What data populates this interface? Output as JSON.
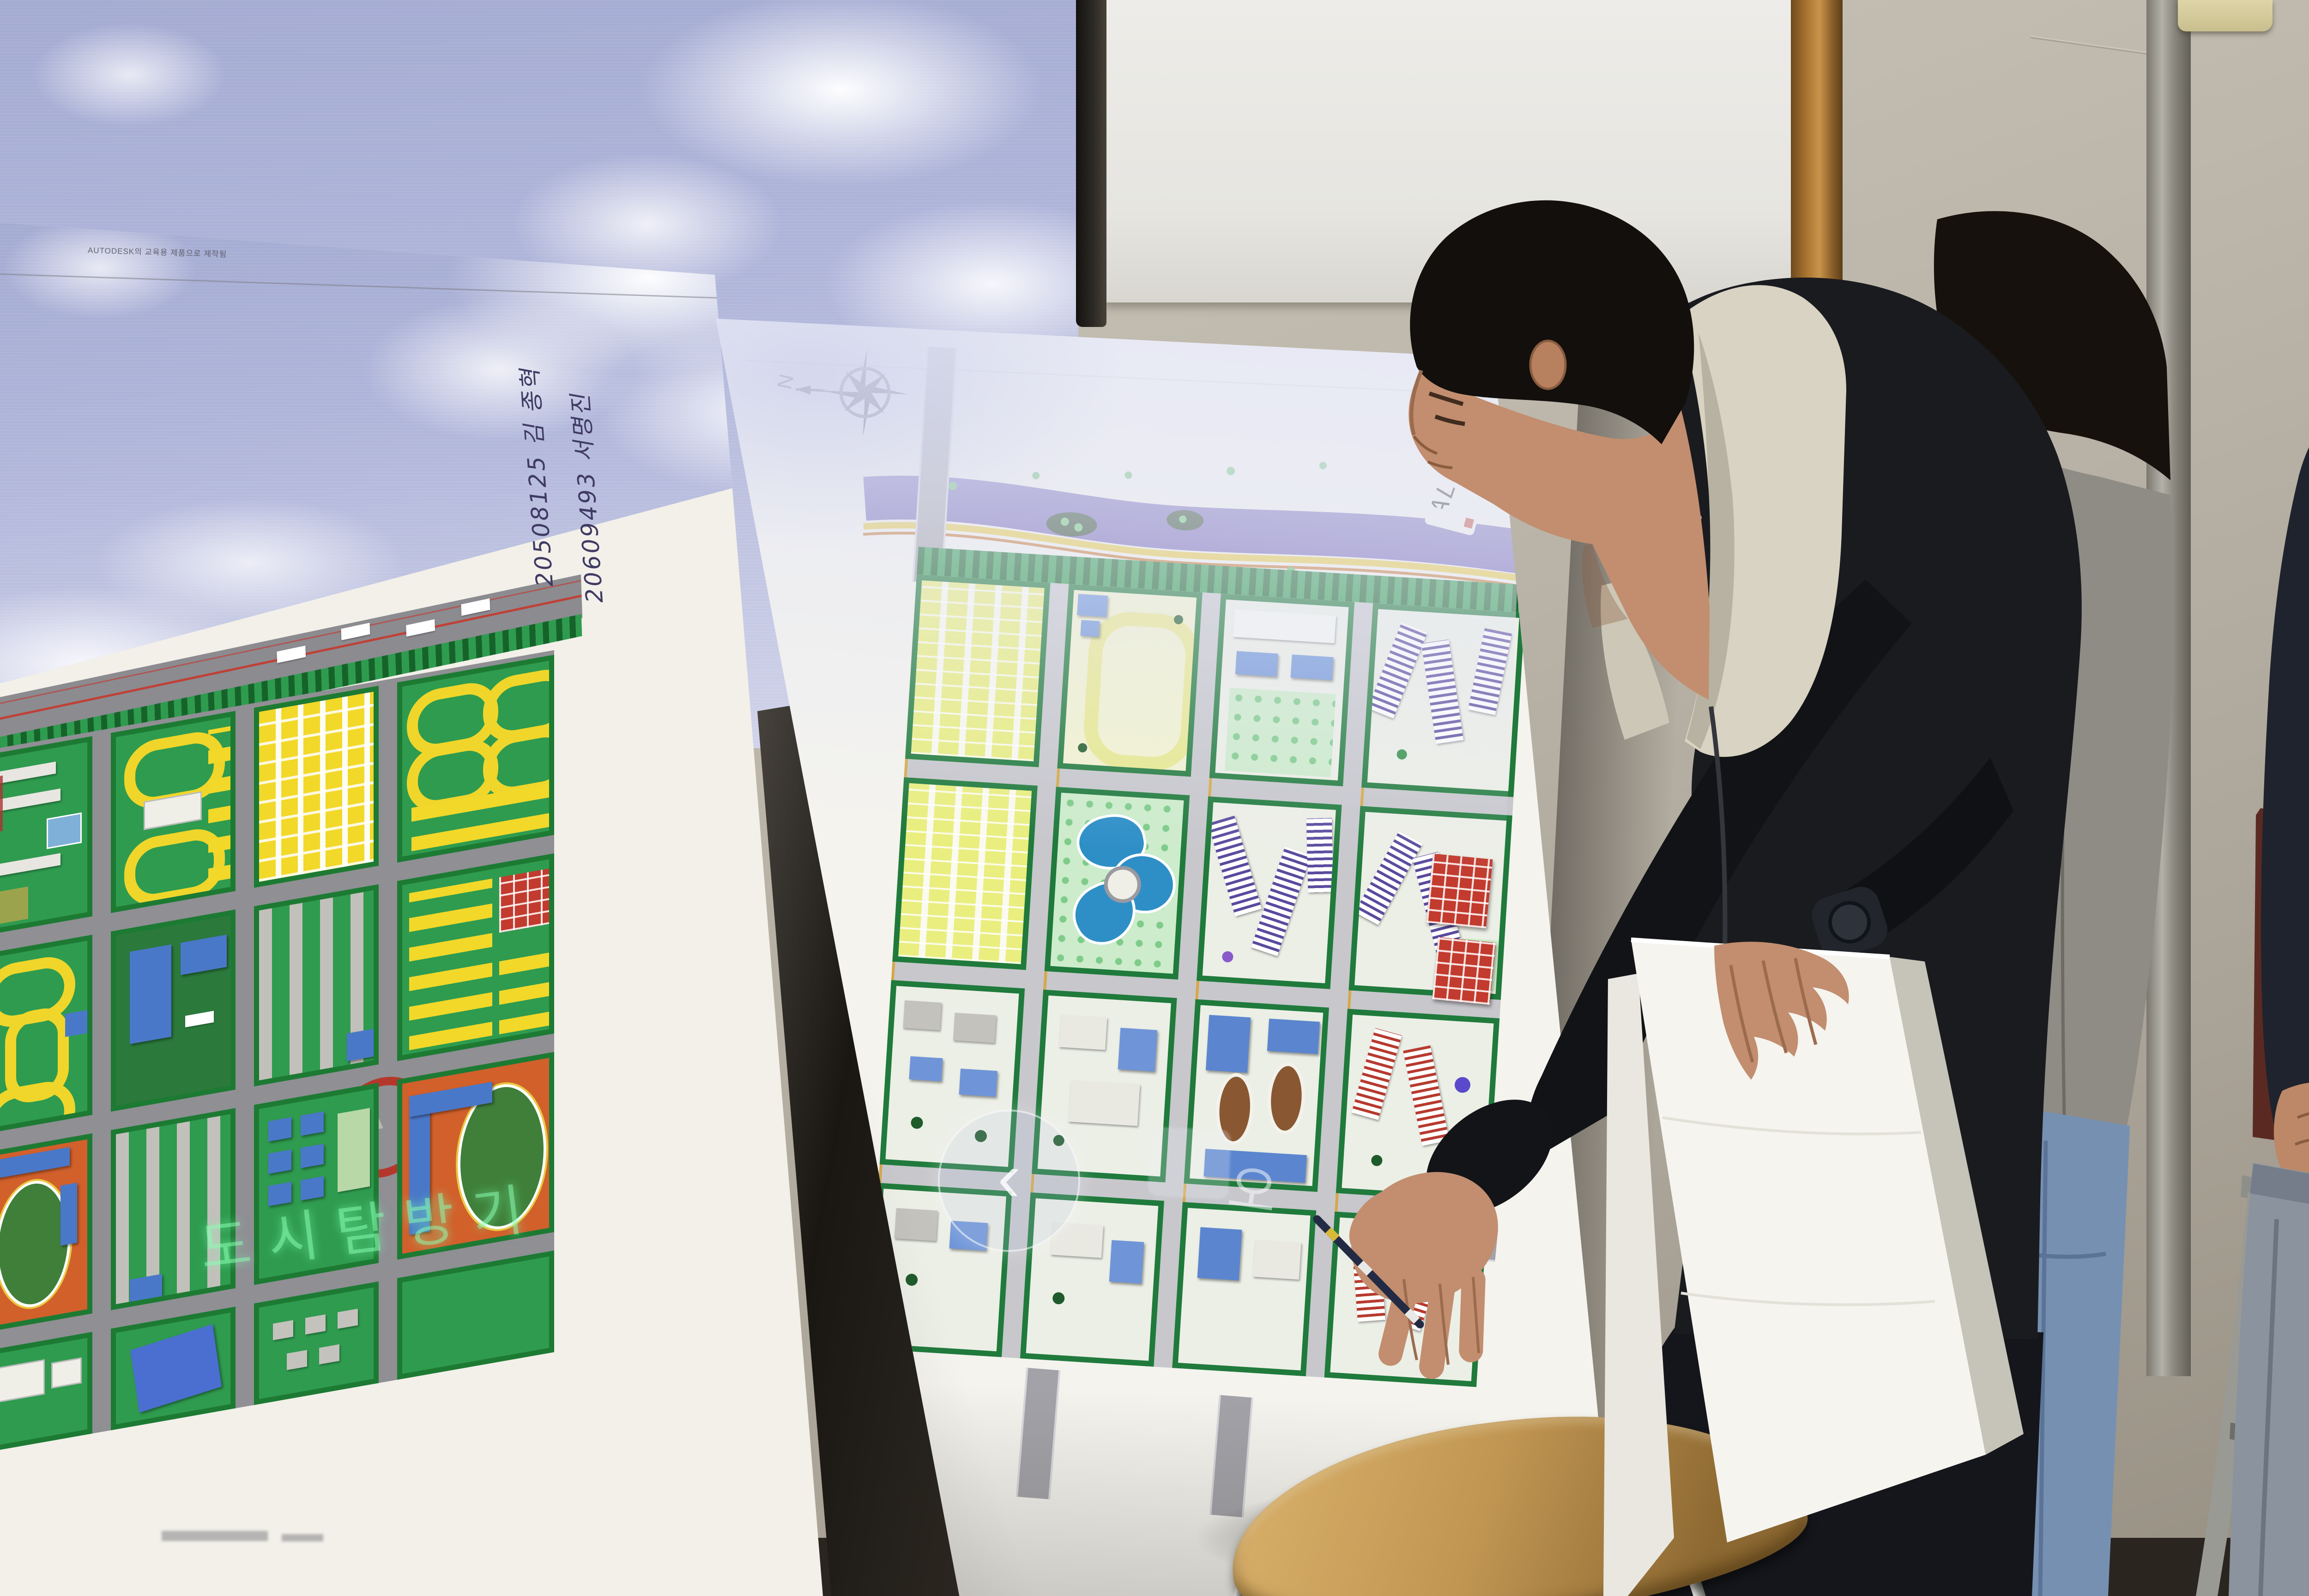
{
  "scene": {
    "type": "classroom photo",
    "description": "Two students present physical urban-planning model posters; a projector casts a cloudy sky image and a photo-viewer UI onto the boards."
  },
  "posters": {
    "left": {
      "watermark": "AUTODESK의 교육용 제품으로 제작됨",
      "handwriting": [
        "20508125 김 종혁",
        "20609493 서명진"
      ],
      "projected_text": "도시탐방기"
    },
    "middle": {
      "compass_label": "N",
      "scale_label": "SCALE  1/2000"
    }
  },
  "projection": {
    "nav_back_glyph": "‹",
    "overlay_glyph": "오"
  },
  "icons": [
    "compass-rose-icon",
    "projected-back-icon"
  ],
  "palette": {
    "wall": "#b6b0a4",
    "sky": "#afb5da",
    "cloud": "#f6f6fa",
    "screen_white": "#ecebe7",
    "poster_paper": "#f3f1ea",
    "map_green": "#2f9b4f",
    "hedge_green": "#1d7a33",
    "map_yellow": "#f2d829",
    "map_orange": "#d2602b",
    "map_blue": "#4a78c8",
    "river_purple": "#6f62b5",
    "lake_blue": "#2e8fc7",
    "red_block": "#c23b2e",
    "purple_stripe": "#5a4a9e",
    "jacket_black": "#1a1b1f",
    "hood_cream": "#d8d3c2",
    "gray_jacket": "#8f8c86",
    "jeans_blue": "#7690b2",
    "jeans_gray": "#8b939e",
    "skin": "#c28e6f",
    "stool_wood": "#c09552",
    "chair_wood": "#5a2a22",
    "cushion_blue": "#3a55b8",
    "wood_trim": "#a9732f"
  }
}
